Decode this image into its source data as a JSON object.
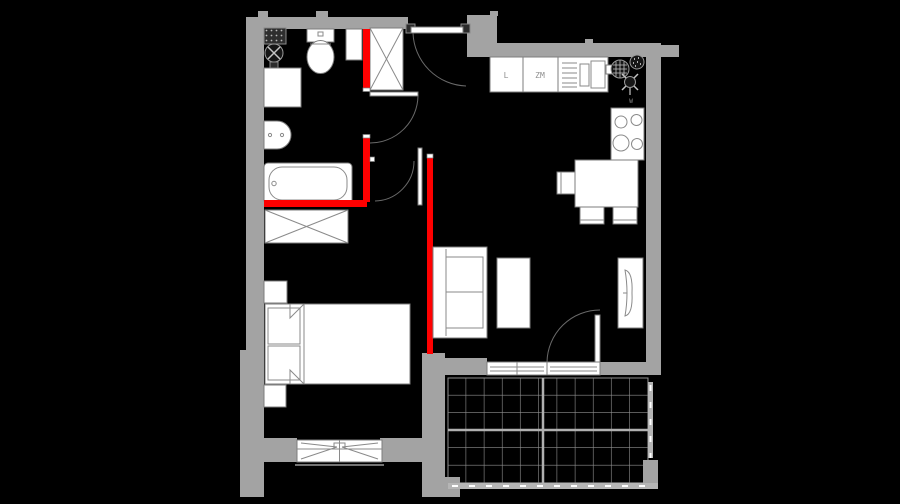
{
  "plan": {
    "name": "apartment-floor-plan",
    "labels": {
      "fridge": "L",
      "dishwasher": "ZM",
      "vent": "W"
    },
    "colors": {
      "background": "#000000",
      "wall": "#a3a3a3",
      "accent": "#ff0000",
      "fixture": "#ffffff",
      "fixture_stroke": "#7d7d7d",
      "railing": "#b5b5b5",
      "tile_line": "#8f8f8f"
    }
  }
}
